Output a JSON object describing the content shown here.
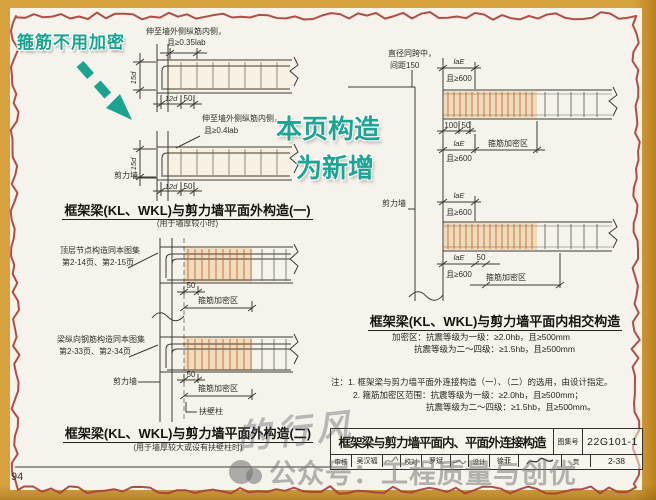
{
  "page": {
    "number": "94"
  },
  "colors": {
    "frame_yellow": "#d7a23d",
    "border_red": "#a84038",
    "annotation_teal": "#1fa392",
    "dense_zone_tan": "#f0dbbb",
    "stirrup_orange": "#c06a38",
    "paper": "#f6f3ec"
  },
  "annotations": {
    "callout": "箍筋不用加密",
    "new_line1": "本页构造",
    "new_line2": "为新增"
  },
  "d1": {
    "label_anchor_top1": "伸至墙外侧纵筋内侧，",
    "label_anchor_top2": "且≥0.35lab",
    "label_anchor_bot1": "伸至墙外侧纵筋内侧，",
    "label_anchor_bot2": "且≥0.4lab",
    "dim_15d": "15d",
    "dim_12d": "12d",
    "dim_50": "50",
    "wall": "剪力墙",
    "title": "框架梁(KL、WKL)与剪力墙平面外构造(一)",
    "subtitle": "(用于墙厚较小时)"
  },
  "d2": {
    "note_top1": "顶层节点构造同本图集",
    "note_top2": "第2-14页、第2-15页",
    "note_mid1": "梁纵向钢筋构造同本图集",
    "note_mid2": "第2-33页、第2-34页",
    "dim_50": "50",
    "dense": "箍筋加密区",
    "wall": "剪力墙",
    "pilaster": "扶壁柱",
    "title": "框架梁(KL、WKL)与剪力墙平面外构造(二)",
    "subtitle": "(用于墙厚较大或设有扶壁柱时)"
  },
  "d3": {
    "note_dia1": "直径同跨中，",
    "note_dia2": "间距150",
    "lae": "laE",
    "ge600": "且≥600",
    "dim_100": "100",
    "dim_50": "50",
    "dense": "箍筋加密区",
    "wall": "剪力墙",
    "title": "框架梁(KL、WKL)与剪力墙平面内相交构造",
    "spec1": "加密区：抗震等级为一级：≥2.0hb，且≥500mm",
    "spec2": "抗震等级为二～四级：≥1.5hb，且≥500mm"
  },
  "notes": {
    "line1": "注：1. 框架梁与剪力墙平面外连接构造（一）、（二）的选用，由设计指定。",
    "line2": "2. 箍筋加密区范围：抗震等级为一级：≥2.0hb，且≥500mm；",
    "line3": "抗震等级为二～四级：≥1.5hb，且≥500mm。"
  },
  "title_block": {
    "main": "框架梁与剪力墙平面内、平面外连接构造",
    "atlas_label": "图集号",
    "atlas_no": "22G101-1",
    "page_label": "页",
    "page_no": "2-38",
    "credits": [
      {
        "label": "审核",
        "name": "吴汉福"
      },
      {
        "label": "校对",
        "name": "罗斌"
      },
      {
        "label": "设计",
        "name": "徐菲"
      }
    ]
  },
  "watermarks": {
    "script": "的行风",
    "official": "公众号：工程质量与创优"
  }
}
